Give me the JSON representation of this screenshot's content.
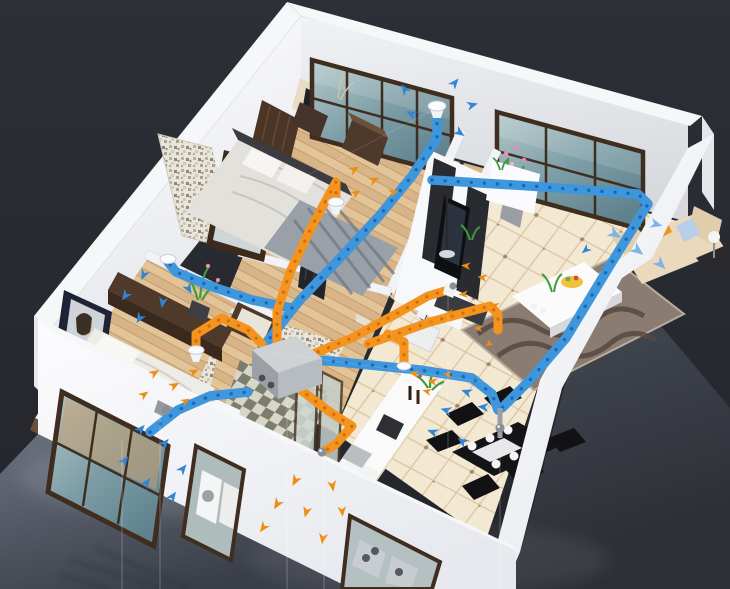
{
  "scene": {
    "type": "isometric-apartment-ventilation-cutaway",
    "view": "3d-floorplan-top-corner-view",
    "rooms": [
      {
        "name": "master-bedroom",
        "floor": "wood",
        "items": [
          "double-bed",
          "headboard-panel",
          "wall-art",
          "nightstand-pair",
          "wardrobe",
          "striped-rug",
          "back-window"
        ]
      },
      {
        "name": "second-bedroom",
        "floor": "wood",
        "items": [
          "double-bed",
          "long-dresser",
          "stool",
          "framed-picture",
          "potted-orchid",
          "front-window"
        ]
      },
      {
        "name": "closet-hall",
        "floor": "wood",
        "items": [
          "mosaic-accent-wall",
          "mirror-wardrobe",
          "vanity-unit"
        ]
      },
      {
        "name": "bathroom",
        "floor": "checker-tile",
        "items": [
          "mosaic-walls",
          "glass-shower",
          "toilet",
          "washer"
        ]
      },
      {
        "name": "entry-hall",
        "floor": "wood",
        "items": [
          "entry-door",
          "step",
          "shoe-cabinet",
          "orchid-pot"
        ]
      },
      {
        "name": "living-room",
        "floor": "beige-tile",
        "items": [
          "tv-wall-unit",
          "television",
          "speaker-panels",
          "floor-lamp",
          "wavy-rug",
          "coffee-table",
          "fruit-bowl",
          "cream-sofa",
          "orange-cushion",
          "blue-cushion",
          "side-table",
          "sphere-lamp",
          "double-window"
        ]
      },
      {
        "name": "kitchen",
        "floor": "beige-tile",
        "items": [
          "island-counter",
          "sink",
          "cooktop",
          "wine-bottles",
          "herb-plant",
          "front-window-stoves"
        ]
      },
      {
        "name": "dining-area",
        "floor": "beige-tile",
        "items": [
          "black-table",
          "white-runner",
          "place-settings",
          "chair-x6"
        ]
      }
    ],
    "ventilation": {
      "unit": "heat-recovery-ventilator-box",
      "supply_air": {
        "color_key": "duct_supply",
        "arrow_color": "blue",
        "terminals": [
          "outdoor-intake-grille",
          "master-bedroom-ceiling-diffuser",
          "second-bedroom-ceiling-diffuser",
          "sofa-run",
          "dining-drop-column"
        ]
      },
      "exhaust_air": {
        "color_key": "duct_exhaust",
        "arrow_color": "orange",
        "terminals": [
          "master-bed-floor-cone",
          "second-bed-floor-cone",
          "living-room-return-cone",
          "kitchen-return-vent",
          "outdoor-exhaust-outlet"
        ]
      }
    },
    "environment": {
      "backdrop": "dark-studio",
      "ground": "glossy-reflective-floor",
      "effects": [
        "wall-reflections",
        "thin-light-wires"
      ]
    }
  },
  "colors": {
    "background": "#272a31",
    "background_top": "#2c2f36",
    "gloss_left_hi": "#6b7280",
    "gloss_left_lo": "#3a3e47",
    "gloss_right_hi": "#4d525c",
    "gloss_right_lo": "#2c2f36",
    "wall_top": "#f5f6f8",
    "wall_face_light": "#fbfcfe",
    "wall_face_shade": "#dcdee3",
    "wall_outer": "#e6e8ec",
    "duct_supply": "#3e96dc",
    "duct_supply_dark": "#1b63ae",
    "duct_exhaust": "#f5931f",
    "duct_exhaust_dark": "#c76a04",
    "arrow_supply": "#2f86d4",
    "arrow_supply_light": "#7db4e6",
    "arrow_exhaust": "#ef8c12",
    "wood_floor": "#ddba8d",
    "wood_line": "#bc9260",
    "tile_floor": "#f3e8d2",
    "tile_line": "#d8c5a2",
    "tile_dot": "#6b4f35",
    "checker_dark": "#7b7d6e",
    "checker_light": "#d9d6c5",
    "mosaic_base": "#e9e5d8",
    "glass_hi": "#b3c9cb",
    "glass_lo": "#5f828d",
    "frame_brown": "#3f2d1f",
    "hrv_top": "#ced2d5",
    "hrv_left": "#9ba0a6",
    "hrv_right": "#b7bcc1",
    "rug_living": "#8a7c70",
    "rug_wave": "#57493f",
    "rug_bedroom": "#9aa0a8",
    "sofa_cream": "#ead9bd",
    "cushion_orange": "#f0921e",
    "cushion_blue": "#b8cfe8",
    "dining_black": "#141417",
    "furniture_brown": "#4e392a",
    "bed_linen": "#eeece6",
    "plant_green": "#3f9b3f",
    "flower_pink": "#e88fb0",
    "bowl_yellow": "#f0c23c",
    "metal_gray": "#8b9096"
  }
}
